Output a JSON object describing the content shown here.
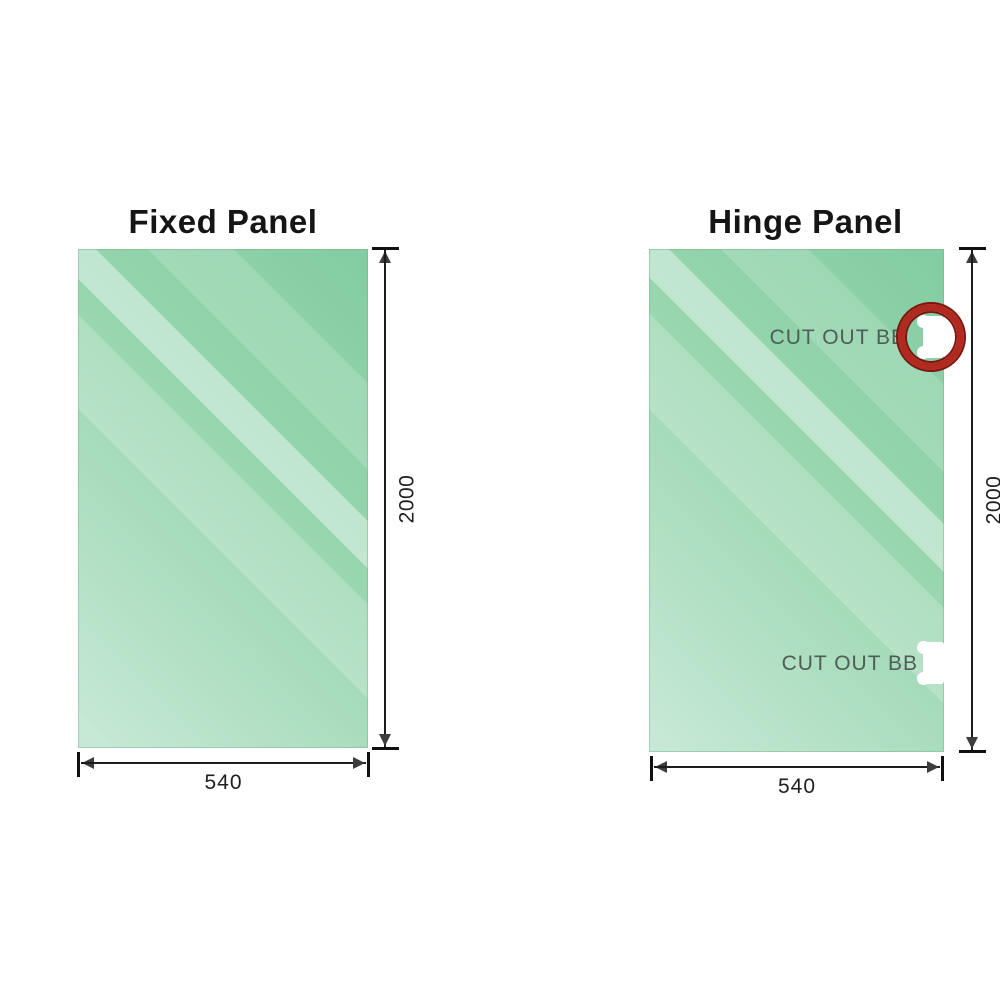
{
  "diagram": {
    "panels": [
      {
        "title": "Fixed Panel",
        "height_dim": "2000",
        "width_dim": "540"
      },
      {
        "title": "Hinge Panel",
        "height_dim": "2000",
        "width_dim": "540",
        "cutout_top_label": "CUT OUT BB",
        "cutout_bottom_label": "CUT OUT BB"
      }
    ],
    "colors": {
      "glass_dark": "#83cca1",
      "glass_light": "#c9e9d7",
      "dimension_line": "#1c1c1c",
      "cutout_label_text": "#4e5d56",
      "highlight_ring": "#b02a1f"
    }
  }
}
